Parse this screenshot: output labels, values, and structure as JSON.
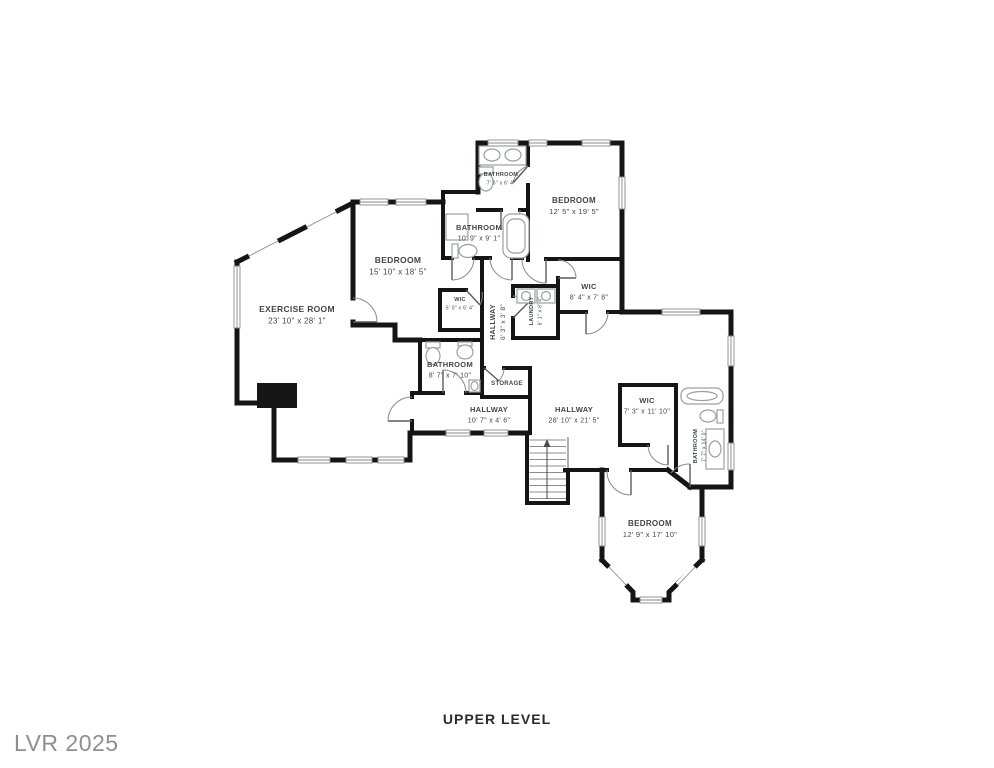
{
  "page": {
    "level_title": "UPPER LEVEL",
    "watermark": "LVR 2025"
  },
  "colors": {
    "wall": "#151515",
    "fixture": "#9aa09d",
    "door": "#8a8a8a",
    "label": "#41464a",
    "title": "#2b2b2b",
    "watermark_color": "#8f8f8f"
  },
  "floor_plan": {
    "level_label": "UPPER LEVEL",
    "rooms": [
      {
        "id": "exercise-room",
        "label": "EXERCISE ROOM",
        "dims": "23' 10\" x 28' 1\"",
        "x": 297,
        "y": 312,
        "rotate": 0,
        "size": 8
      },
      {
        "id": "bedroom-west",
        "label": "BEDROOM",
        "dims": "15' 10\" x 18' 5\"",
        "x": 398,
        "y": 263,
        "rotate": 0,
        "size": 8
      },
      {
        "id": "bathroom-top",
        "label": "BATHROOM",
        "dims": "7' 6\" x 6' 4\"",
        "x": 501,
        "y": 176,
        "rotate": 0,
        "size": 5
      },
      {
        "id": "bathroom-north",
        "label": "BATHROOM",
        "dims": "10' 9\" x 9' 1\"",
        "x": 479,
        "y": 230,
        "rotate": 0,
        "size": 7
      },
      {
        "id": "bedroom-north",
        "label": "BEDROOM",
        "dims": "12' 5\" x 19' 5\"",
        "x": 574,
        "y": 203,
        "rotate": 0,
        "size": 7.5
      },
      {
        "id": "wic-small",
        "label": "WIC",
        "dims": "5' 0\" x 6' 4\"",
        "x": 460,
        "y": 301,
        "rotate": 0,
        "size": 5
      },
      {
        "id": "hallway-center",
        "label": "HALLWAY",
        "dims": "6' 3\" x 3' 8\"",
        "x": 495,
        "y": 322,
        "rotate": -90,
        "size": 6.5
      },
      {
        "id": "laundry",
        "label": "LAUNDRY",
        "dims": "6' 1\" x 6' 4\"",
        "x": 533,
        "y": 311,
        "rotate": -90,
        "size": 5
      },
      {
        "id": "wic-north",
        "label": "WIC",
        "dims": "8' 4\" x 7' 8\"",
        "x": 589,
        "y": 289,
        "rotate": 0,
        "size": 7
      },
      {
        "id": "bathroom-center",
        "label": "BATHROOM",
        "dims": "8' 7\" x 7' 10\"",
        "x": 450,
        "y": 367,
        "rotate": 0,
        "size": 7
      },
      {
        "id": "storage",
        "label": "STORAGE",
        "dims": "",
        "x": 507,
        "y": 385,
        "rotate": 0,
        "size": 5.5
      },
      {
        "id": "hallway-west",
        "label": "HALLWAY",
        "dims": "10' 7\" x 4' 6\"",
        "x": 489,
        "y": 412,
        "rotate": 0,
        "size": 7
      },
      {
        "id": "hallway-main",
        "label": "HALLWAY",
        "dims": "28' 10\" x 21' 5\"",
        "x": 574,
        "y": 412,
        "rotate": 0,
        "size": 7
      },
      {
        "id": "wic-east",
        "label": "WIC",
        "dims": "7' 3\" x 11' 10\"",
        "x": 647,
        "y": 403,
        "rotate": 0,
        "size": 7
      },
      {
        "id": "bathroom-east",
        "label": "BATHROOM",
        "dims": "7' 7\" x 14' 0\"",
        "x": 697,
        "y": 446,
        "rotate": -90,
        "size": 5
      },
      {
        "id": "bedroom-south",
        "label": "BEDROOM",
        "dims": "12' 9\" x 17' 10\"",
        "x": 650,
        "y": 526,
        "rotate": 0,
        "size": 7.5
      }
    ]
  }
}
